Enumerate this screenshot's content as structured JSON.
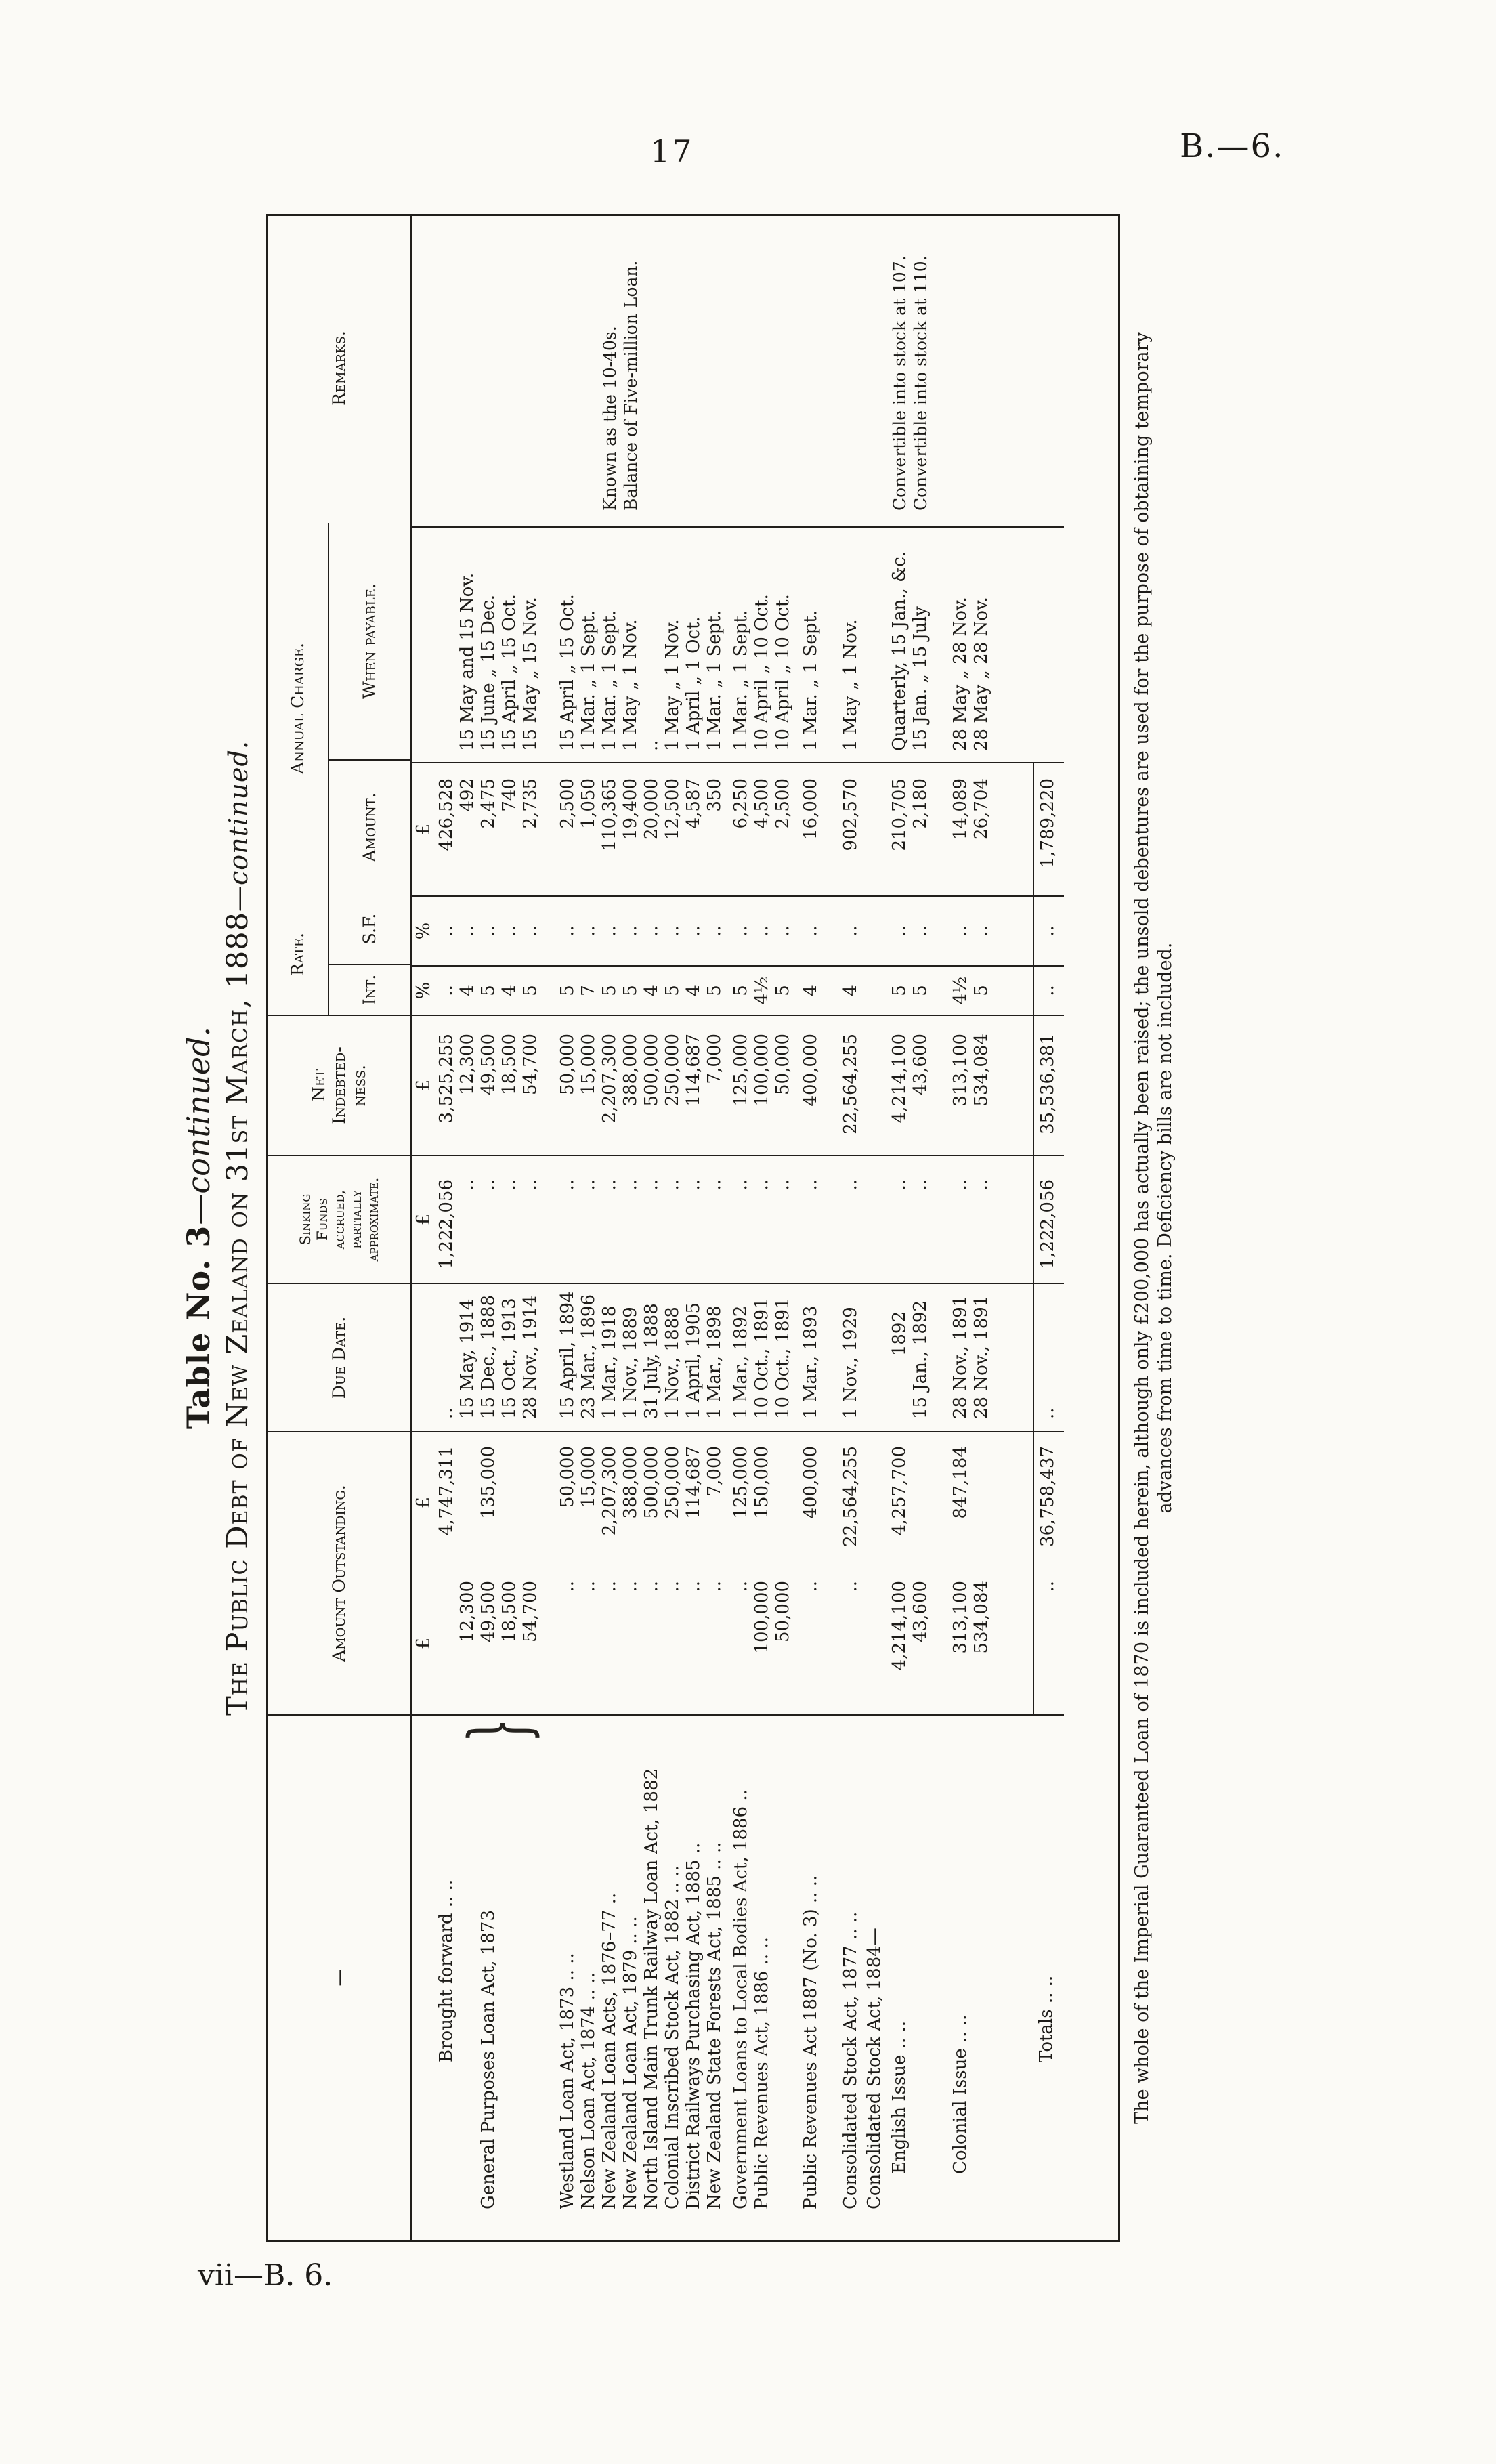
{
  "page": {
    "number": "17",
    "heading_right": "B.—6.",
    "bottom_caption": "vii—B. 6."
  },
  "title": {
    "line1_bold": "Table No. 3",
    "line1_italic": "—continued.",
    "line2_main": "The Public Debt of New Zealand on 31st March, 1888",
    "line2_italic": "—continued."
  },
  "glyphs": {
    "brace": "}"
  },
  "units": {
    "pound": "£",
    "percent": "%"
  },
  "headers": {
    "names": "—",
    "outstanding": "Amount Outstanding.",
    "due": "Due Date.",
    "sinking": "Sinking\nFunds\naccrued,\npartially\napproximate.",
    "net": "Net\nIndebted-\nness.",
    "rate": "Rate.",
    "int": "Int.",
    "sf": "S.F.",
    "annual": "Annual Charge.",
    "amount": "Amount.",
    "when": "When payable.",
    "remarks": "Remarks."
  },
  "table": {
    "rows": [
      {
        "name": "Brought forward  ..  ..",
        "comp": "",
        "out": "4,747,311",
        "due": "..",
        "sink": "1,222,056",
        "net": "3,525,255",
        "int": "..",
        "sf": "..",
        "amt": "426,528",
        "when": "",
        "rem": ""
      },
      {
        "name": "",
        "comp": "12,300",
        "out": "",
        "due": "15 May, 1914",
        "sink": "..",
        "net": "12,300",
        "int": "4",
        "sf": "..",
        "amt": "492",
        "when": "15 May and 15 Nov.",
        "rem": ""
      },
      {
        "name": "General Purposes Loan Act, 1873",
        "comp": "49,500",
        "out": "135,000",
        "due": "15 Dec., 1888",
        "sink": "..",
        "net": "49,500",
        "int": "5",
        "sf": "..",
        "amt": "2,475",
        "when": "15 June „ 15 Dec.",
        "rem": ""
      },
      {
        "name": "",
        "comp": "18,500",
        "out": "",
        "due": "15 Oct., 1913",
        "sink": "..",
        "net": "18,500",
        "int": "4",
        "sf": "..",
        "amt": "740",
        "when": "15 April „ 15 Oct.",
        "rem": ""
      },
      {
        "name": "",
        "comp": "54,700",
        "out": "",
        "due": "28 Nov., 1914",
        "sink": "..",
        "net": "54,700",
        "int": "5",
        "sf": "..",
        "amt": "2,735",
        "when": "15 May „ 15 Nov.",
        "rem": ""
      },
      {
        "name": "Westland Loan Act, 1873  ..  ..",
        "comp": "..",
        "out": "50,000",
        "due": "15 April, 1894",
        "sink": "..",
        "net": "50,000",
        "int": "5",
        "sf": "..",
        "amt": "2,500",
        "when": "15 April „ 15 Oct.",
        "rem": ""
      },
      {
        "name": "Nelson Loan Act, 1874  ..  ..",
        "comp": "..",
        "out": "15,000",
        "due": "23 Mar., 1896",
        "sink": "..",
        "net": "15,000",
        "int": "7",
        "sf": "..",
        "amt": "1,050",
        "when": "1 Mar. „ 1 Sept.",
        "rem": ""
      },
      {
        "name": "New Zealand Loan Acts, 1876–77  ..",
        "comp": "..",
        "out": "2,207,300",
        "due": "1 Mar., 1918",
        "sink": "..",
        "net": "2,207,300",
        "int": "5",
        "sf": "..",
        "amt": "110,365",
        "when": "1 Mar. „ 1 Sept.",
        "rem": "Known as the 10-40s."
      },
      {
        "name": "New Zealand Loan Act, 1879  ..  ..",
        "comp": "..",
        "out": "388,000",
        "due": "1 Nov., 1889",
        "sink": "..",
        "net": "388,000",
        "int": "5",
        "sf": "..",
        "amt": "19,400",
        "when": "1 May „ 1 Nov.",
        "rem": "Balance of Five-million Loan."
      },
      {
        "name": "North Island Main Trunk Railway Loan Act, 1882",
        "comp": "..",
        "out": "500,000",
        "due": "31 July, 1888",
        "sink": "..",
        "net": "500,000",
        "int": "4",
        "sf": "..",
        "amt": "20,000",
        "when": "..",
        "rem": ""
      },
      {
        "name": "Colonial Inscribed Stock Act, 1882  ..  ..",
        "comp": "..",
        "out": "250,000",
        "due": "1 Nov., 1888",
        "sink": "..",
        "net": "250,000",
        "int": "5",
        "sf": "..",
        "amt": "12,500",
        "when": "1 May „ 1 Nov.",
        "rem": ""
      },
      {
        "name": "District Railways Purchasing Act, 1885  ..",
        "comp": "..",
        "out": "114,687",
        "due": "1 April, 1905",
        "sink": "..",
        "net": "114,687",
        "int": "4",
        "sf": "..",
        "amt": "4,587",
        "when": "1 April „ 1 Oct.",
        "rem": ""
      },
      {
        "name": "New Zealand State Forests Act, 1885  ..  ..",
        "comp": "..",
        "out": "7,000",
        "due": "1 Mar., 1898",
        "sink": "..",
        "net": "7,000",
        "int": "5",
        "sf": "..",
        "amt": "350",
        "when": "1 Mar. „ 1 Sept.",
        "rem": ""
      },
      {
        "name": "Government Loans to Local Bodies Act, 1886  ..",
        "comp": "..",
        "out": "125,000",
        "due": "1 Mar., 1892",
        "sink": "..",
        "net": "125,000",
        "int": "5",
        "sf": "..",
        "amt": "6,250",
        "when": "1 Mar. „ 1 Sept.",
        "rem": ""
      },
      {
        "name": "Public Revenues Act, 1886  ..  ..",
        "comp": "100,000",
        "out": "150,000",
        "due": "10 Oct., 1891",
        "sink": "..",
        "net": "100,000",
        "int": "4½",
        "sf": "..",
        "amt": "4,500",
        "when": "10 April „ 10 Oct.",
        "rem": ""
      },
      {
        "name": "",
        "comp": "50,000",
        "out": "",
        "due": "10 Oct., 1891",
        "sink": "..",
        "net": "50,000",
        "int": "5",
        "sf": "..",
        "amt": "2,500",
        "when": "10 April „ 10 Oct.",
        "rem": ""
      },
      {
        "name": "Public Revenues Act 1887 (No. 3)  ..  ..",
        "comp": "..",
        "out": "400,000",
        "due": "1 Mar., 1893",
        "sink": "..",
        "net": "400,000",
        "int": "4",
        "sf": "..",
        "amt": "16,000",
        "when": "1 Mar. „ 1 Sept.",
        "rem": ""
      },
      {
        "name": "Consolidated Stock Act, 1877  ..  ..",
        "comp": "..",
        "out": "22,564,255",
        "due": "1 Nov., 1929",
        "sink": "..",
        "net": "22,564,255",
        "int": "4",
        "sf": "..",
        "amt": "902,570",
        "when": "1 May „ 1 Nov.",
        "rem": ""
      },
      {
        "name": "Consolidated Stock Act, 1884—",
        "comp": "",
        "out": "",
        "due": "",
        "sink": "",
        "net": "",
        "int": "",
        "sf": "",
        "amt": "",
        "when": "",
        "rem": ""
      },
      {
        "name": "English Issue  ..  ..",
        "comp": "4,214,100",
        "out": "4,257,700",
        "due": "1892",
        "sink": "..",
        "net": "4,214,100",
        "int": "5",
        "sf": "..",
        "amt": "210,705",
        "when": "Quarterly, 15 Jan., &c.",
        "rem": "Convertible into stock at 107."
      },
      {
        "name": "",
        "comp": "43,600",
        "out": "",
        "due": "15 Jan., 1892",
        "sink": "..",
        "net": "43,600",
        "int": "5",
        "sf": "..",
        "amt": "2,180",
        "when": "15 Jan. „ 15 July",
        "rem": "Convertible into stock at 110."
      },
      {
        "name": "Colonial Issue  ..  ..",
        "comp": "313,100",
        "out": "847,184",
        "due": "28 Nov., 1891",
        "sink": "..",
        "net": "313,100",
        "int": "4½",
        "sf": "..",
        "amt": "14,089",
        "when": "28 May „ 28 Nov.",
        "rem": ""
      },
      {
        "name": "",
        "comp": "534,084",
        "out": "",
        "due": "28 Nov., 1891",
        "sink": "..",
        "net": "534,084",
        "int": "5",
        "sf": "..",
        "amt": "26,704",
        "when": "28 May „ 28 Nov.",
        "rem": ""
      },
      {
        "name": "Totals  ..  ..",
        "comp": "..",
        "out": "36,758,437",
        "due": "..",
        "sink": "1,222,056",
        "net": "35,536,381",
        "int": "..",
        "sf": "..",
        "amt": "1,789,220",
        "when": "",
        "rem": ""
      }
    ]
  },
  "footnote": {
    "line1": "The whole of the Imperial Guaranteed Loan of 1870 is included herein, although only £200,000 has actually been raised; the unsold debentures are used for the purpose of obtaining temporary",
    "line2": "advances from time to time.  Deficiency bills are not included."
  }
}
